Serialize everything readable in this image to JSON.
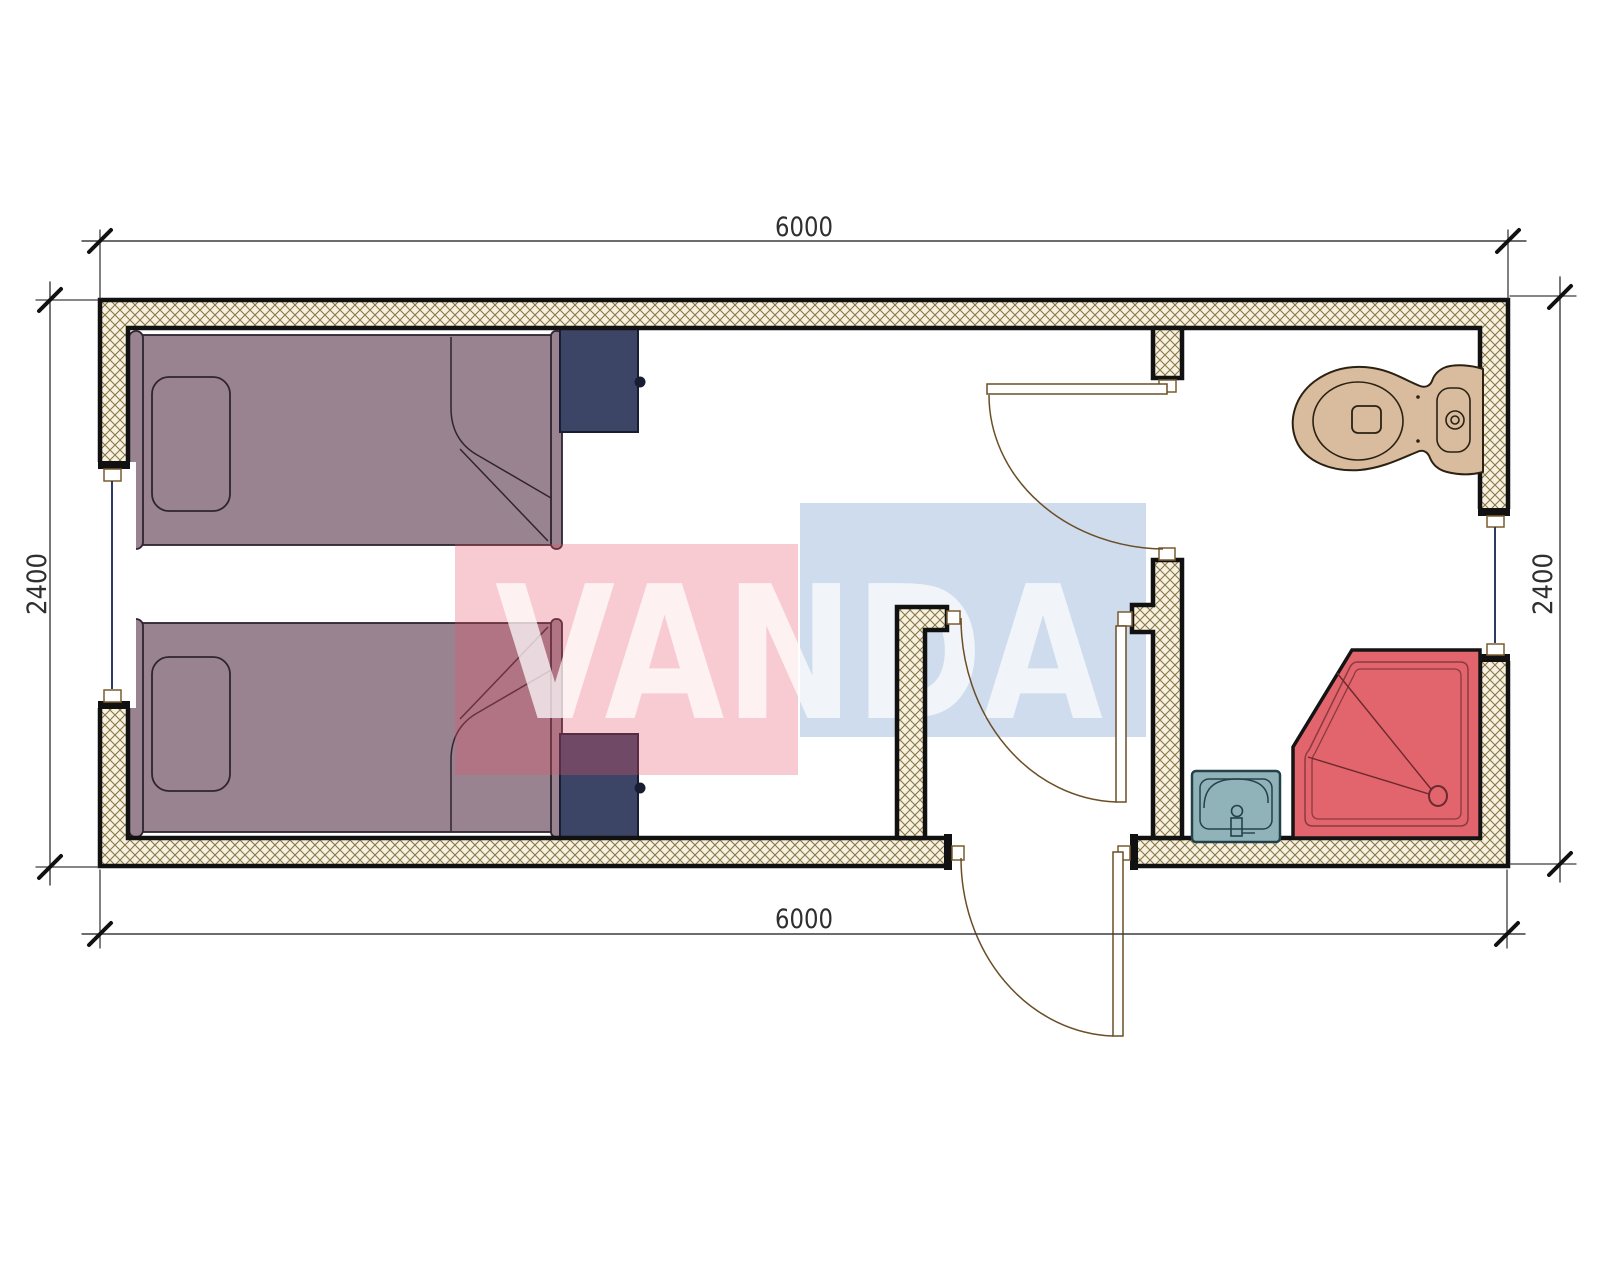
{
  "page": {
    "background": "#ffffff",
    "kind": "architectural-floor-plan"
  },
  "dimensions": {
    "top": {
      "label": "6000"
    },
    "bottom": {
      "label": "6000"
    },
    "left": {
      "label": "2400"
    },
    "right": {
      "label": "2400"
    }
  },
  "watermark": {
    "text": "VANDA",
    "red_color": "#e45266",
    "blue_color": "#5c8ac3",
    "text_color": "#ffffff"
  },
  "colors": {
    "bed": "#9a8391",
    "bed_outline": "#2e2430",
    "nightstand": "#3d4566",
    "nightstand_outline": "#191d33",
    "toilet": "#d9bc9e",
    "toilet_outline": "#2a2113",
    "shower": "#e2646c",
    "shower_inner_line": "#8c3a40",
    "sink": "#8fb3b8",
    "sink_outline": "#24414a",
    "wall_hatch_bg": "#f7f1e0",
    "wall_hatch_line": "#887748",
    "wall_outline": "#111111",
    "window_line": "#2b3a6b",
    "door_line": "#6a4e26",
    "dimension_text": "#2f2f2f"
  },
  "plan_contents": {
    "furniture": [
      "bed-1",
      "bed-2",
      "nightstand-1",
      "nightstand-2"
    ],
    "fixtures": [
      "toilet",
      "shower-tray",
      "sink"
    ],
    "doors": 3,
    "windows": 2
  }
}
